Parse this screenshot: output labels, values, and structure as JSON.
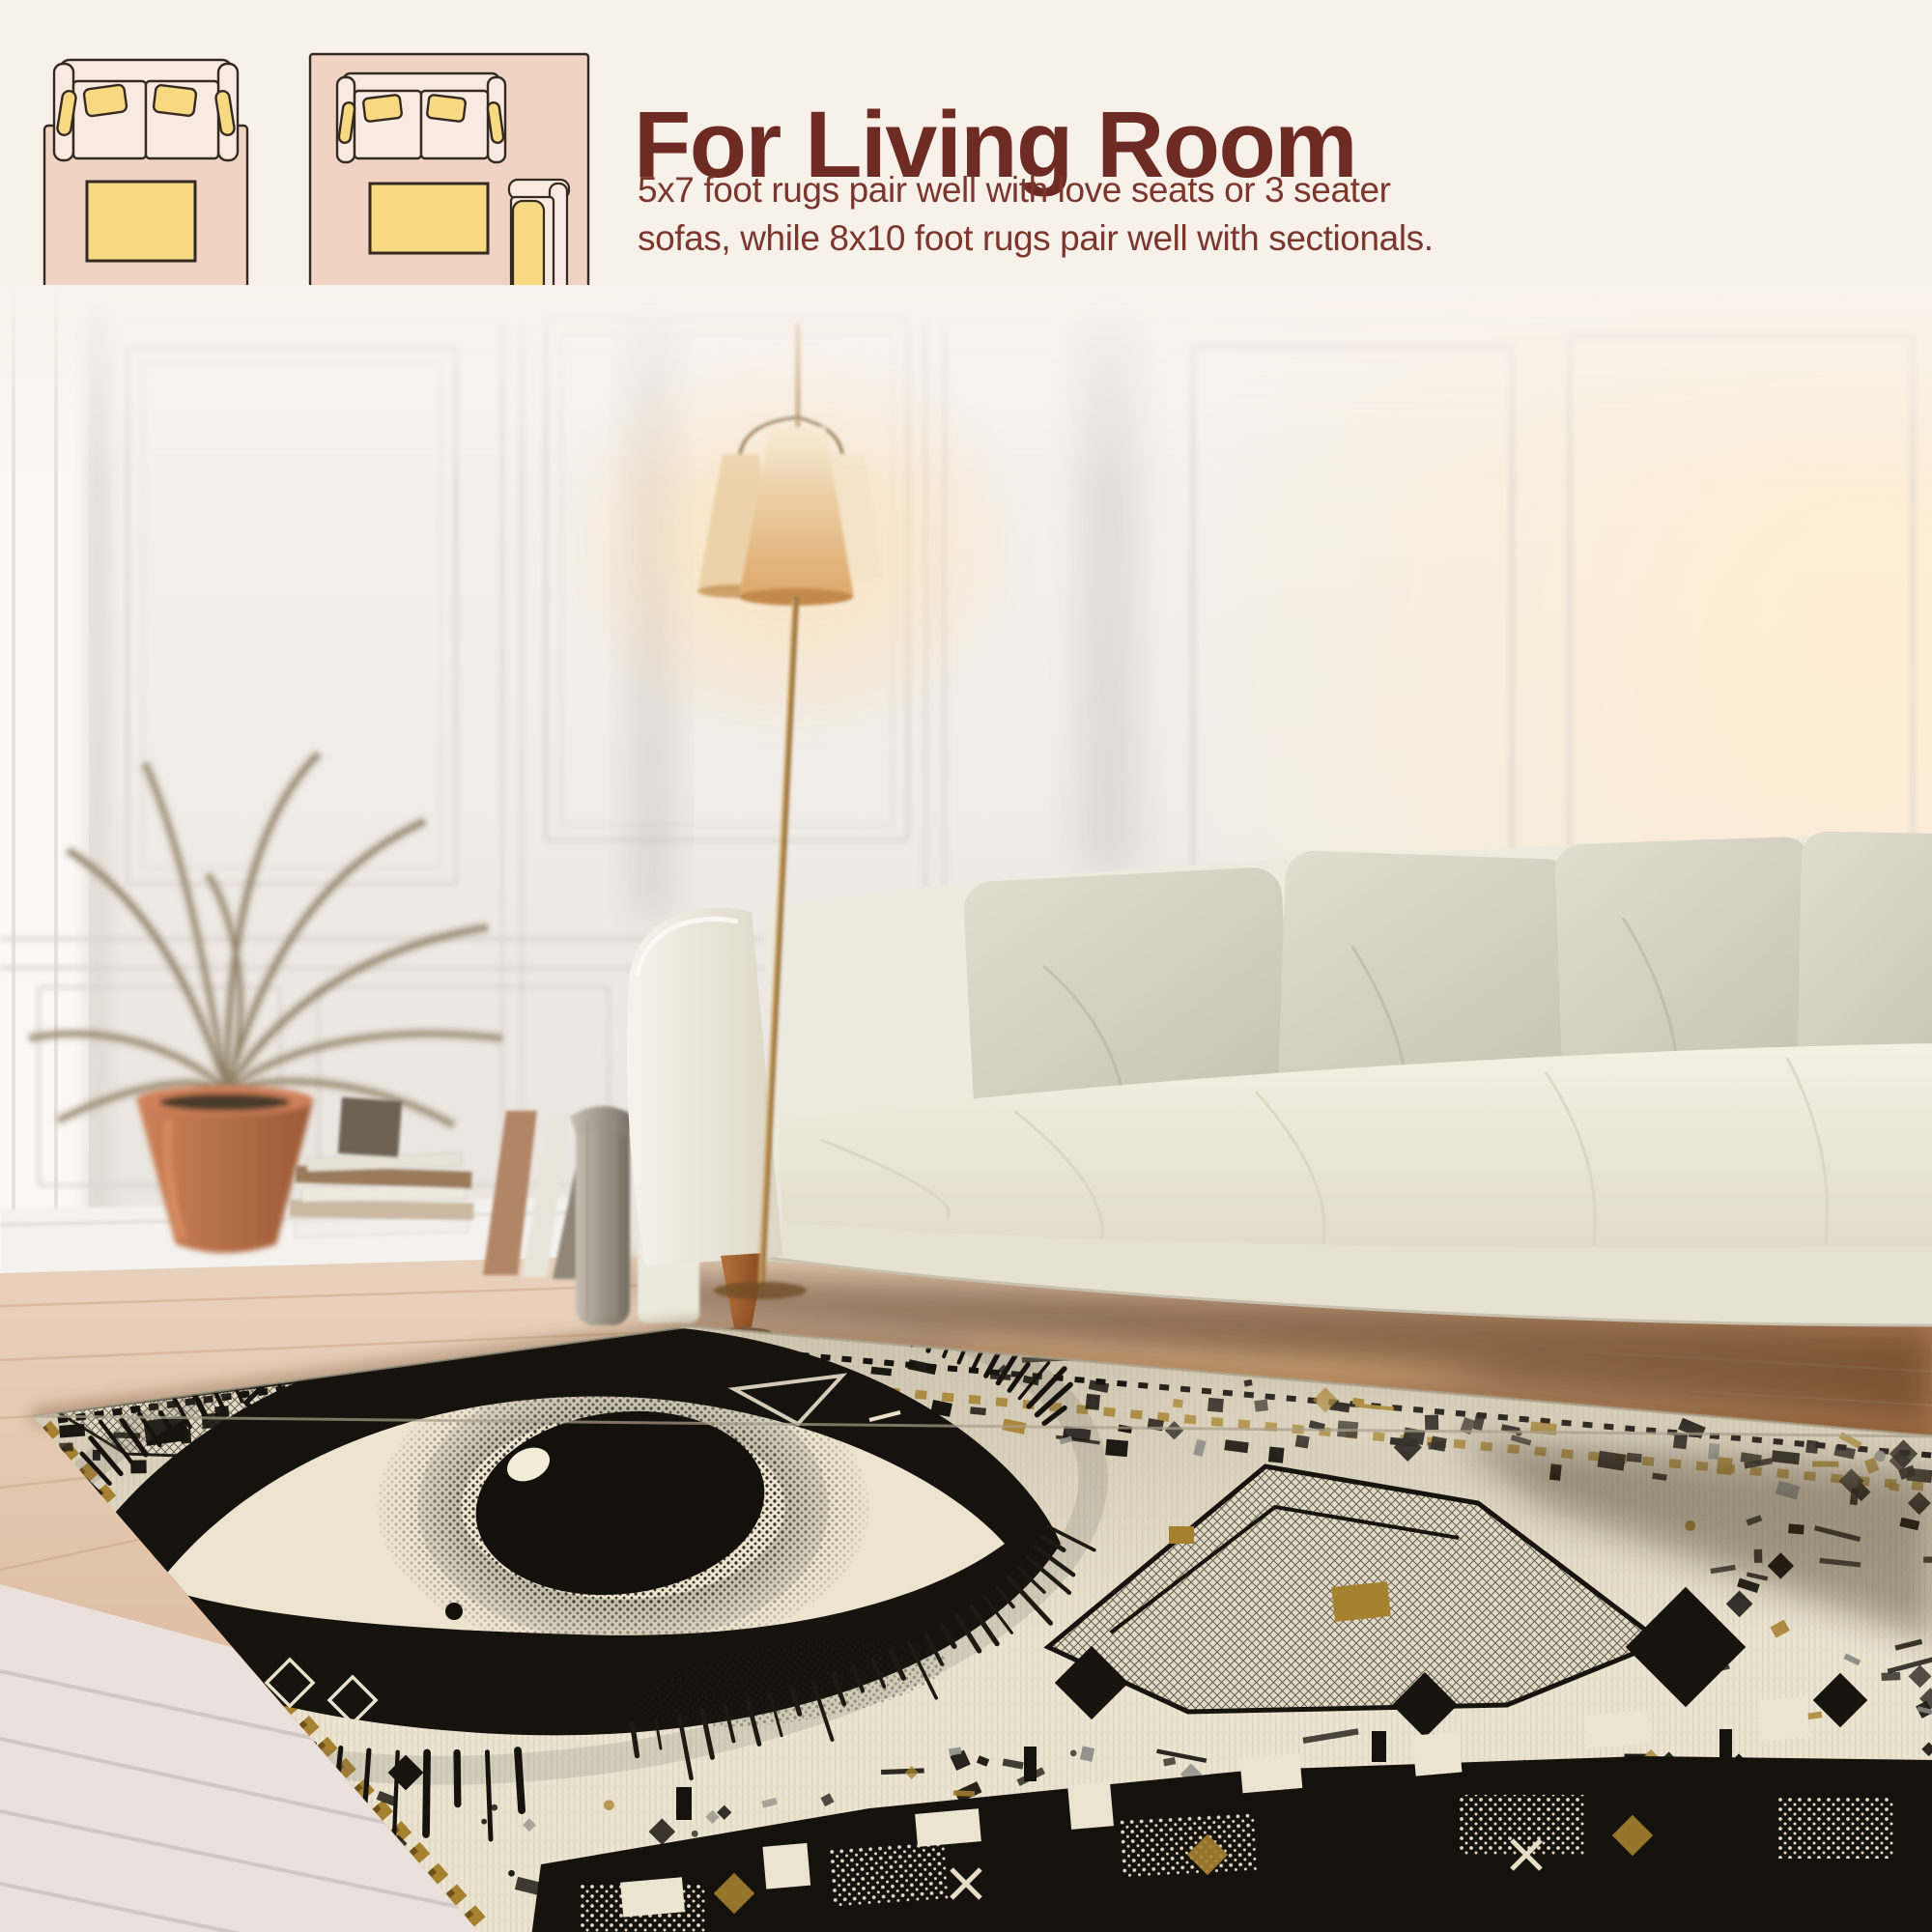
{
  "page": {
    "background_color": "#f8f1ea"
  },
  "size_guide": {
    "diagrams": [
      {
        "label": "5x7",
        "icon": "loveseat-and-coffee-table-on-rug-top-view-icon"
      },
      {
        "label": "8x10",
        "icon": "sofa-coffee-table-and-armchair-on-rug-top-view-icon"
      }
    ],
    "colors": {
      "rug": "#f0d3c3",
      "furniture": "#f9eae1",
      "cushion": "#f6d980",
      "outline": "#342a21",
      "label": "#5f4a38"
    }
  },
  "header": {
    "title": "For Living Room",
    "description_lines": [
      "5x7 foot rugs pair well with love seats or 3 seater",
      "sofas, while 8x10 foot rugs pair well with sectionals."
    ],
    "colors": {
      "title": "#6e2b24",
      "description": "#7b362e"
    }
  },
  "photo": {
    "description": "Bright living room with white paneled wall, cream sofa with four beige pillows, twin-cone floor lamp, dried palm in terracotta pot, stacked books and leaning frames, wood floor, and a cream area rug with a large black woven eye motif, geometric border and gold accents",
    "objects": [
      "paneled-wall",
      "wood-floor",
      "dried-palm-plant",
      "terracotta-pot",
      "book-stack",
      "leaning-frames",
      "fluted-vase",
      "floor-lamp",
      "white-sofa",
      "throw-pillows",
      "eye-motif-area-rug"
    ],
    "rug_colors": {
      "base": "#ebe4d1",
      "motif": "#17130e",
      "accent_gold": "#a6812f",
      "accent_gray": "#8f8f8a"
    }
  }
}
